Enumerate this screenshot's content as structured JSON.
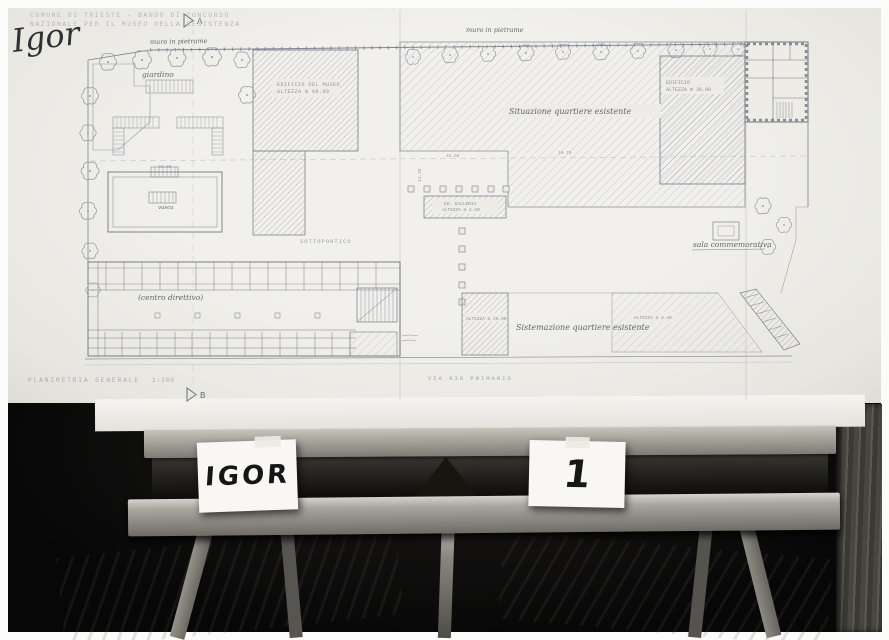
{
  "photo": {
    "competition_header": {
      "line1": "COMUNE DI TRIESTE - BANDO DI CONCORSO",
      "line2": "NAZIONALE PER IL MUSEO DELLA RESISTENZA"
    },
    "signature": "Igor"
  },
  "plan": {
    "caption": {
      "title": "PLANIMETRIA GENERALE",
      "scale": "1:200"
    },
    "section_markers": {
      "a": "A",
      "b": "B"
    },
    "street": "VIA RIO PRIMARIO",
    "labels": {
      "wall_top_left": "muro in pietrame",
      "wall_top_center": "muro in pietrame",
      "garden": "giardino",
      "pool": "vasca",
      "museum_1": "EDIFICIO DEL MUSEO",
      "museum_2": "ALTEZZA m 08.00",
      "quarter_existing_top": "Situazione quartiere esistente",
      "quarter_existing_bottom": "Sistemazione quartiere esistente",
      "tall_building_1": "EDIFICIO",
      "tall_building_2": "ALTEZZA m 30.00",
      "gallery_1": "ED. GALLERIA",
      "gallery_2": "ALTEZZA m 2.50",
      "portico": "SOTTOPORTICO",
      "directional_center": "(centro direttivo)",
      "memorial_hall": "sala commemorativa",
      "height_20": "ALTEZZA m 20.00",
      "height_3_40": "ALTEZZA m 3.40"
    },
    "dimensions": [
      "45.60",
      "19.70",
      "14.40",
      "20.05"
    ]
  },
  "easel": {
    "card_left": "IGOR",
    "card_right": "1"
  },
  "colors": {
    "paper": "#edece7",
    "pencil": "#868b94",
    "ink": "#2f3034",
    "wood_light": "#b7b4ad",
    "room_dark": "#0a0a09"
  }
}
